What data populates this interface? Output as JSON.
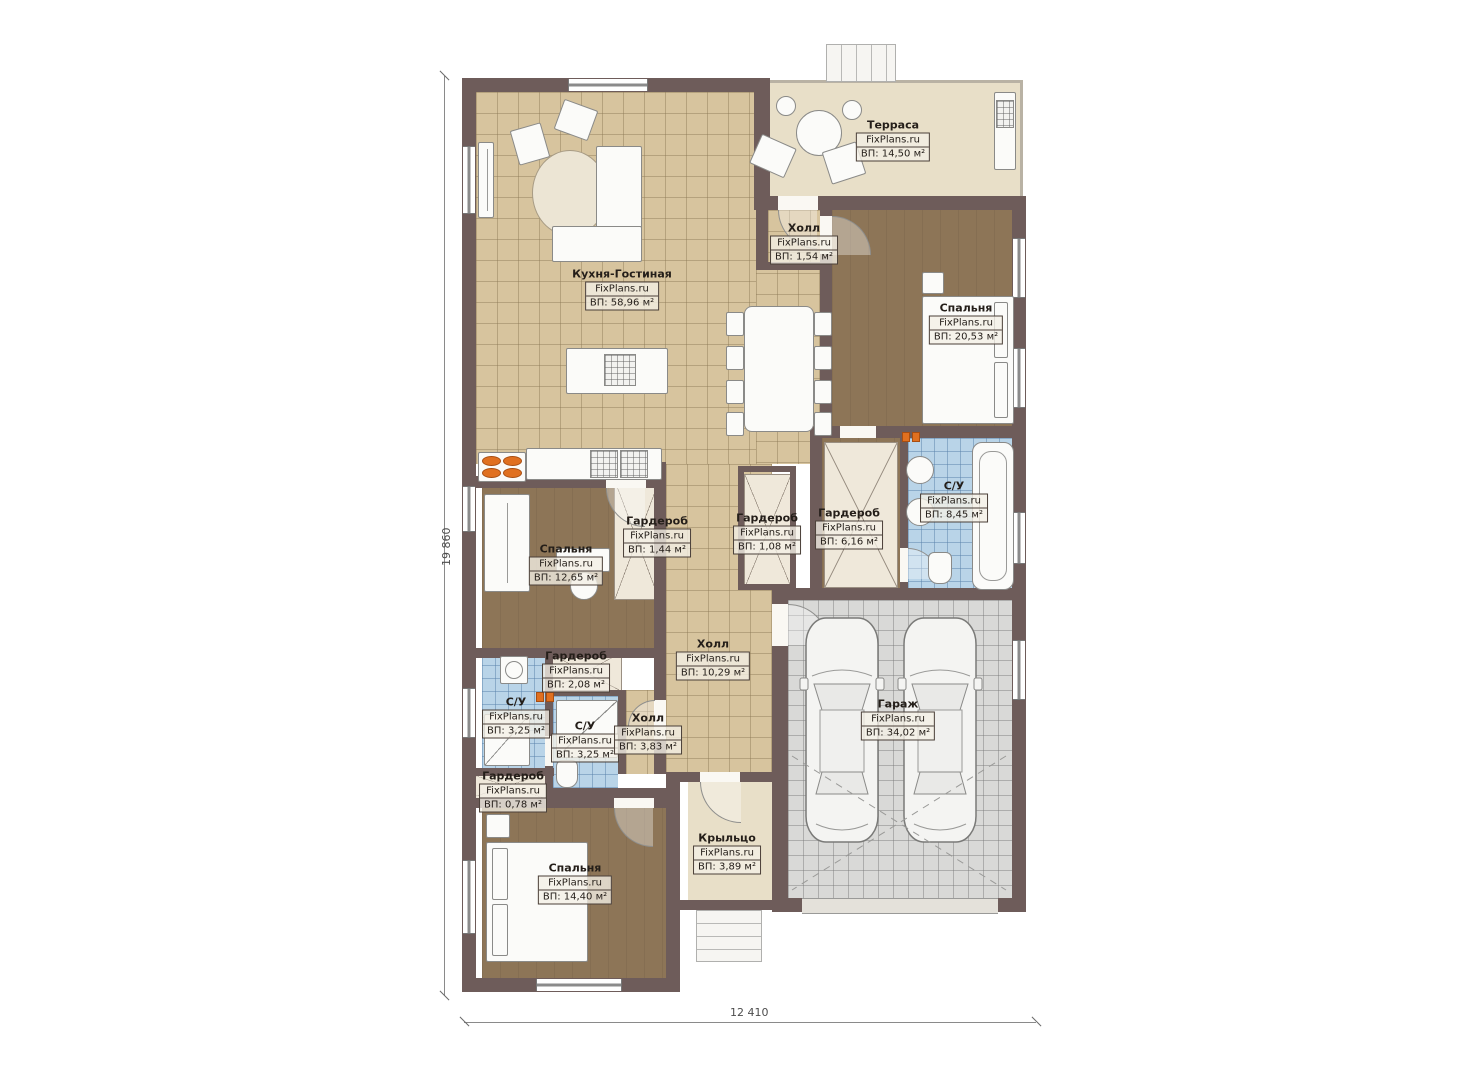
{
  "plan": {
    "brand": "FixPlans.ru",
    "dim_left": "19 860",
    "dim_bottom": "12 410",
    "colors": {
      "wall": "#6e5c5a",
      "tile_floor": "#d7c49e",
      "wood_floor": "#8d7557",
      "terrace_floor": "#e8dfc8",
      "bath_tile": "#b9d4e8",
      "garage_tile": "#d9d9d7",
      "accent_orange": "#e07020"
    },
    "rooms": [
      {
        "name": "Терраса",
        "area": "ВП: 14,50 м²"
      },
      {
        "name": "Холл",
        "area": "ВП: 1,54 м²"
      },
      {
        "name": "Кухня-Гостиная",
        "area": "ВП: 58,96 м²"
      },
      {
        "name": "Спальня",
        "area": "ВП: 20,53 м²"
      },
      {
        "name": "С/У",
        "area": "ВП: 8,45 м²"
      },
      {
        "name": "Гардероб",
        "area": "ВП: 1,44 м²"
      },
      {
        "name": "Гардероб",
        "area": "ВП: 1,08 м²"
      },
      {
        "name": "Гардероб",
        "area": "ВП: 6,16 м²"
      },
      {
        "name": "Спальня",
        "area": "ВП: 12,65 м²"
      },
      {
        "name": "Холл",
        "area": "ВП: 10,29 м²"
      },
      {
        "name": "Гараж",
        "area": "ВП: 34,02 м²"
      },
      {
        "name": "Гардероб",
        "area": "ВП: 2,08 м²"
      },
      {
        "name": "С/У",
        "area": "ВП: 3,25 м²"
      },
      {
        "name": "С/У",
        "area": "ВП: 3,25 м²"
      },
      {
        "name": "Холл",
        "area": "ВП: 3,83 м²"
      },
      {
        "name": "Гардероб",
        "area": "ВП: 0,78 м²"
      },
      {
        "name": "Спальня",
        "area": "ВП: 14,40 м²"
      },
      {
        "name": "Крыльцо",
        "area": "ВП: 3,89 м²"
      }
    ]
  }
}
